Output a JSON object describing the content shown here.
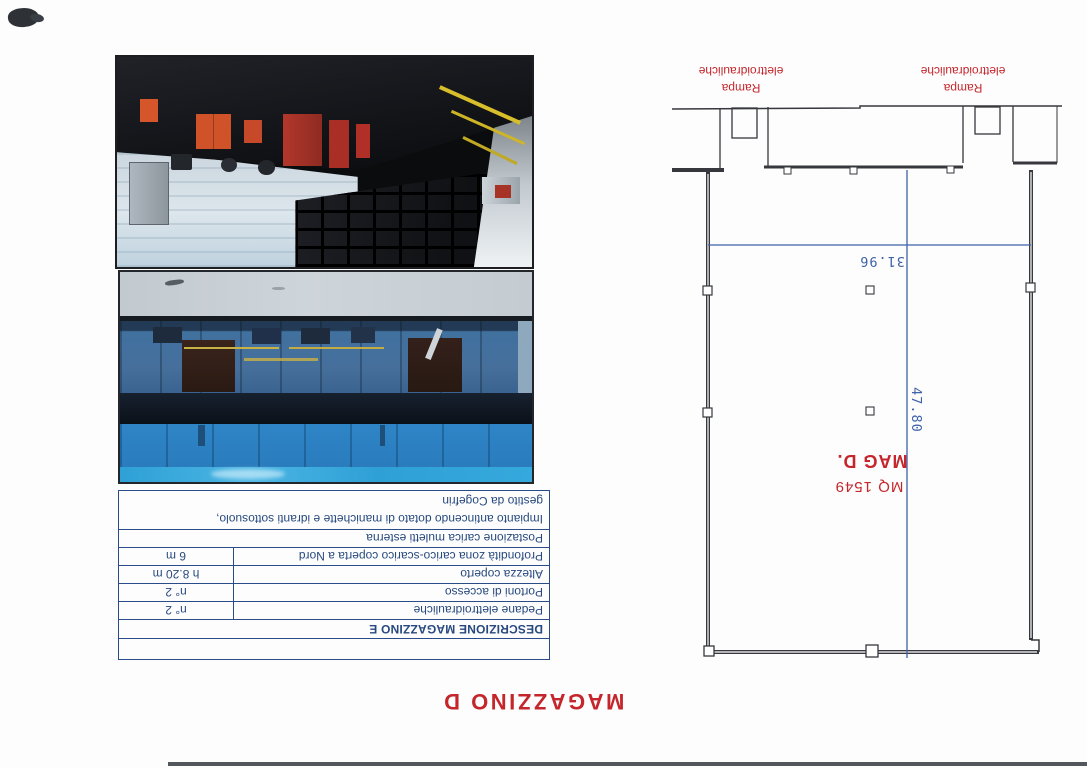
{
  "page": {
    "title": "MAGAZZINO D",
    "background": "#fdfdfd",
    "accent_red": "#c5262c",
    "dimension_blue": "#3f62a8",
    "table_ink": "#27497f"
  },
  "table": {
    "header": "DESCRIZIONE MAGAZZINO E",
    "rows": [
      {
        "label": "Pedane elettroidrauliche",
        "value": "n° 2"
      },
      {
        "label": "Portoni di accesso",
        "value": "n° 2"
      },
      {
        "label": "Altezza coperto",
        "value": "h 8.20 m"
      },
      {
        "label": "Profondità zona carico-scarico coperta a Nord",
        "value": "6 m"
      },
      {
        "label": "Postazione carica muletti esterna",
        "value": ""
      }
    ],
    "note_line1": "Impianto antincendo dotato di manichette e idranti sottosuolo,",
    "note_line2": "gestito da Cogefrin"
  },
  "plan": {
    "room_name": "MAG D.",
    "room_area": "MQ 1549",
    "width_dim": "31.96",
    "depth_dim": "47.80",
    "ramp_label_line1": "Rampa",
    "ramp_label_line2": "elettroidrauliche"
  }
}
